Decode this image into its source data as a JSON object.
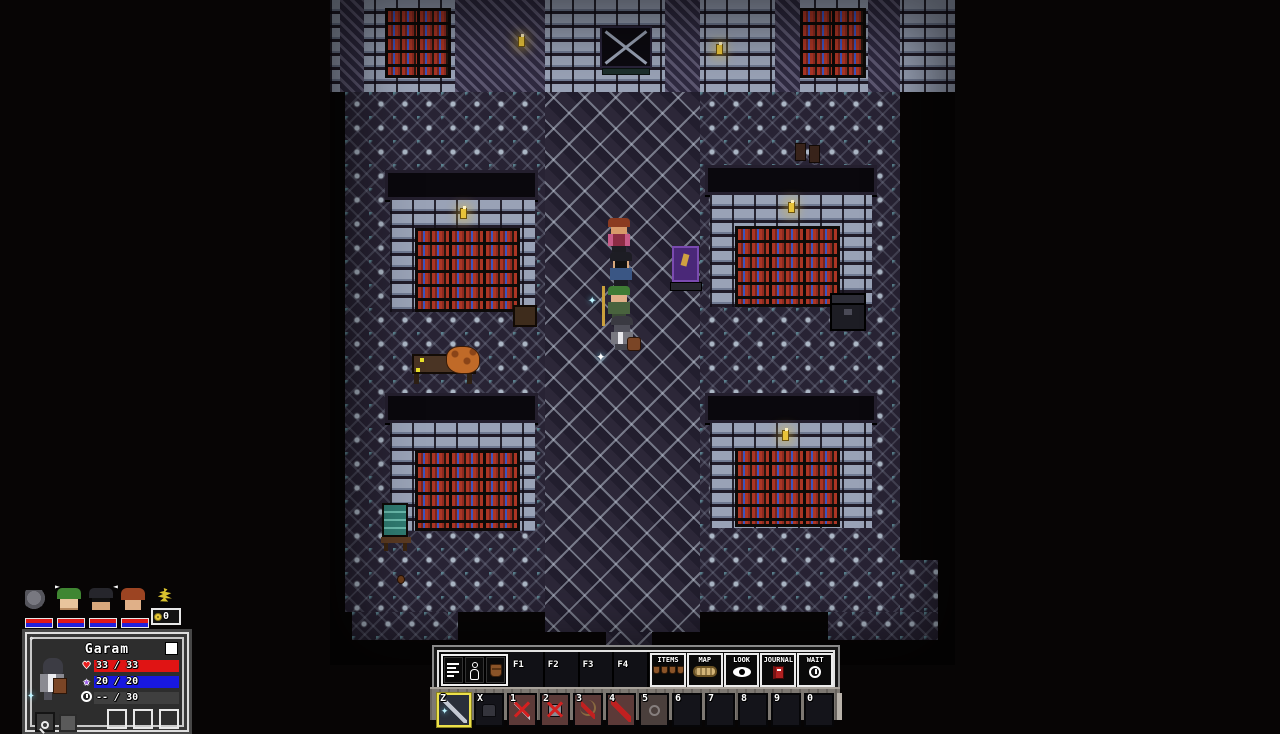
{
  "map": {
    "title": "library-hall",
    "accent_colors": {
      "book_red": "#ab3524",
      "book_blue": "#3b55c0",
      "floor": "#272233",
      "brick": "#99a2b6",
      "banner_purple": "#4a2878",
      "sign_teal": "#2f7a70"
    },
    "props": {
      "banner": "purple-banner-sign",
      "sign": "teal-notice-board",
      "creature": "orange-beast-on-table",
      "chest": "dark-chest",
      "boots": "boots-pair"
    }
  },
  "hud": {
    "party": {
      "arrows": {
        "right": "►",
        "left": "◄"
      },
      "portraits": [
        {
          "icon": "stone-portrait"
        },
        {
          "icon": "green-hair-portrait"
        },
        {
          "icon": "glasses-portrait"
        },
        {
          "icon": "red-hair-portrait"
        }
      ]
    },
    "gold": {
      "amount": "0"
    },
    "character_panel": {
      "name": "Garam",
      "stats": [
        {
          "name": "health",
          "icon": "heart-icon",
          "glyph": "♥",
          "current": "33",
          "sep": "/",
          "max": "33",
          "bar_color": "#e01414"
        },
        {
          "name": "mana",
          "icon": "star-icon",
          "glyph": "★",
          "current": "20",
          "sep": "/",
          "max": "20",
          "bar_color": "#1818e0"
        },
        {
          "name": "energy",
          "icon": "clock-icon",
          "glyph": "",
          "current": "--",
          "sep": "/",
          "max": "30",
          "bar_color": "#3f3f3f"
        }
      ]
    },
    "toolbar": {
      "fkeys": [
        {
          "label": "F1"
        },
        {
          "label": "F2"
        },
        {
          "label": "F3"
        },
        {
          "label": "F4"
        }
      ],
      "buttons": [
        {
          "label": "ITEMS",
          "icon": "pouches-icon"
        },
        {
          "label": "MAP",
          "icon": "map-scroll-icon"
        },
        {
          "label": "LOOK",
          "icon": "eye-icon"
        },
        {
          "label": "JOURNAL",
          "icon": "book-icon"
        },
        {
          "label": "WAIT",
          "icon": "clock-icon"
        }
      ]
    },
    "hotbar": {
      "slots": [
        {
          "key": "Z",
          "icon": "spear-icon",
          "selected": true
        },
        {
          "key": "X",
          "icon": "armor-icon"
        },
        {
          "key": "1",
          "icon": "dagger-crossed-icon"
        },
        {
          "key": "2",
          "icon": "armor-crossed-icon"
        },
        {
          "key": "3",
          "icon": "bow-crossed-icon"
        },
        {
          "key": "4",
          "icon": "red-blade-icon"
        },
        {
          "key": "5",
          "icon": "ring-icon"
        },
        {
          "key": "6",
          "icon": ""
        },
        {
          "key": "7",
          "icon": ""
        },
        {
          "key": "8",
          "icon": ""
        },
        {
          "key": "9",
          "icon": ""
        },
        {
          "key": "0",
          "icon": ""
        }
      ]
    }
  }
}
